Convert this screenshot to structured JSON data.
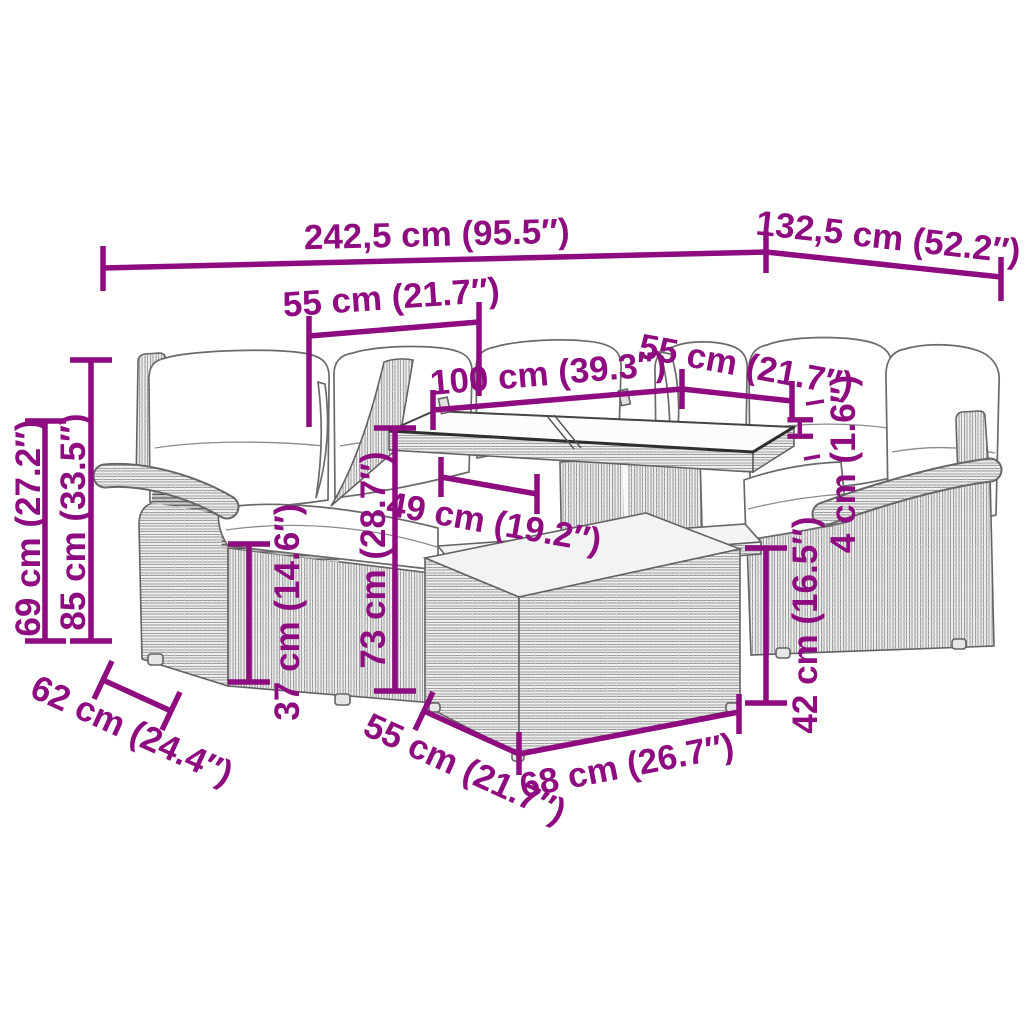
{
  "title": "garden-furniture-set-dimension-diagram",
  "colors": {
    "dimension_accent": "#8E0C80",
    "line_art": "#636363",
    "background": "#FFFFFF"
  },
  "dimensions": {
    "overall_width": "242,5 cm (95.5″)",
    "overall_depth": "132,5 cm (52.2″)",
    "left_seat_width": "55 cm (21.7″)",
    "table_length": "100 cm (39.3″)",
    "right_seat_width": "55 cm (21.7″)",
    "height_total": "85 cm (33.5″)",
    "height_back": "69 cm (27.2″)",
    "seat_height": "37 cm (14.6″)",
    "seat_depth": "62 cm (24.4″)",
    "table_height": "73 cm (28.7″)",
    "shelf_width": "49 cm (19.2″)",
    "ottoman_depth": "55 cm (21.7″)",
    "ottoman_width": "68 cm (26.7″)",
    "ottoman_height": "42 cm (16.5″)",
    "glass_label": "H",
    "glass_thickness": "4 cm (1.6″)"
  }
}
